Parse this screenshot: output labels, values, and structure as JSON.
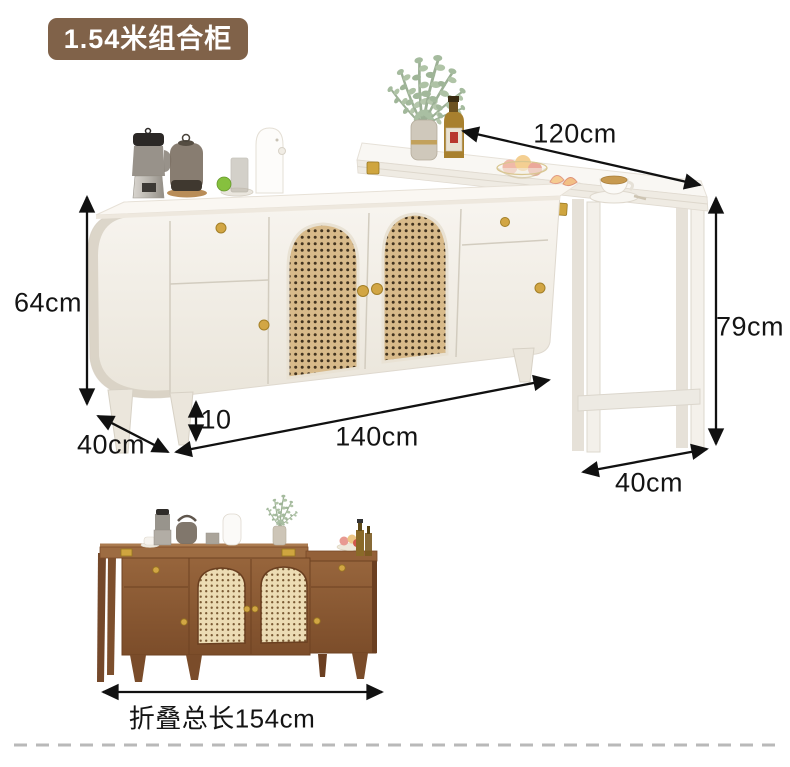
{
  "badge": {
    "label": "1.54米组合柜"
  },
  "main_view": {
    "dimensions": {
      "table_length": "120cm",
      "cabinet_height": "64cm",
      "cabinet_depth": "40cm",
      "leg_height": "10",
      "cabinet_width": "140cm",
      "table_height": "79cm",
      "table_depth": "40cm"
    }
  },
  "folded_view": {
    "caption": "折叠总长154cm"
  },
  "colors": {
    "badge_background": "#806249",
    "badge_text": "#ffffff",
    "dimension_text": "#141414",
    "arrow": "#111111",
    "gold_hardware": "#cfa53f",
    "rattan_tan": "#d8ba8a",
    "white_cabinet": "#f4f0e9",
    "walnut_wood": "#8f5c35",
    "divider_dash": "#b9b9b9"
  }
}
